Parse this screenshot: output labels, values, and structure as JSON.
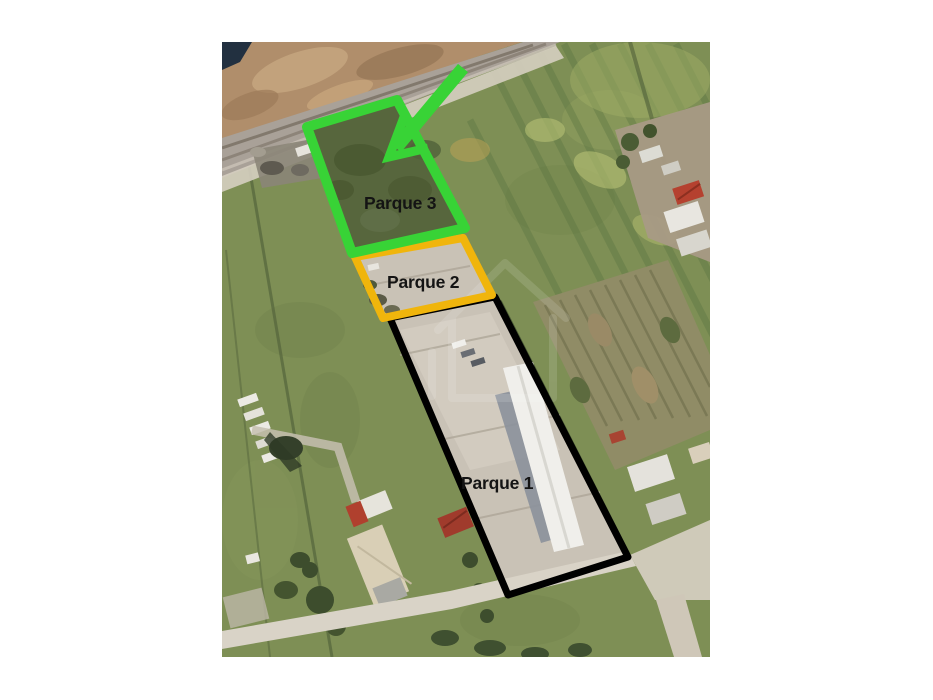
{
  "annotations": {
    "label_color": "#141414",
    "parcels": [
      {
        "id": "parque-3",
        "label": "Parque 3",
        "outline_color": "#38d336"
      },
      {
        "id": "parque-2",
        "label": "Parque 2",
        "outline_color": "#f0b50c"
      },
      {
        "id": "parque-1",
        "label": "Parque 1",
        "outline_color": "#000000"
      }
    ],
    "arrow": {
      "color": "#38d336"
    }
  }
}
